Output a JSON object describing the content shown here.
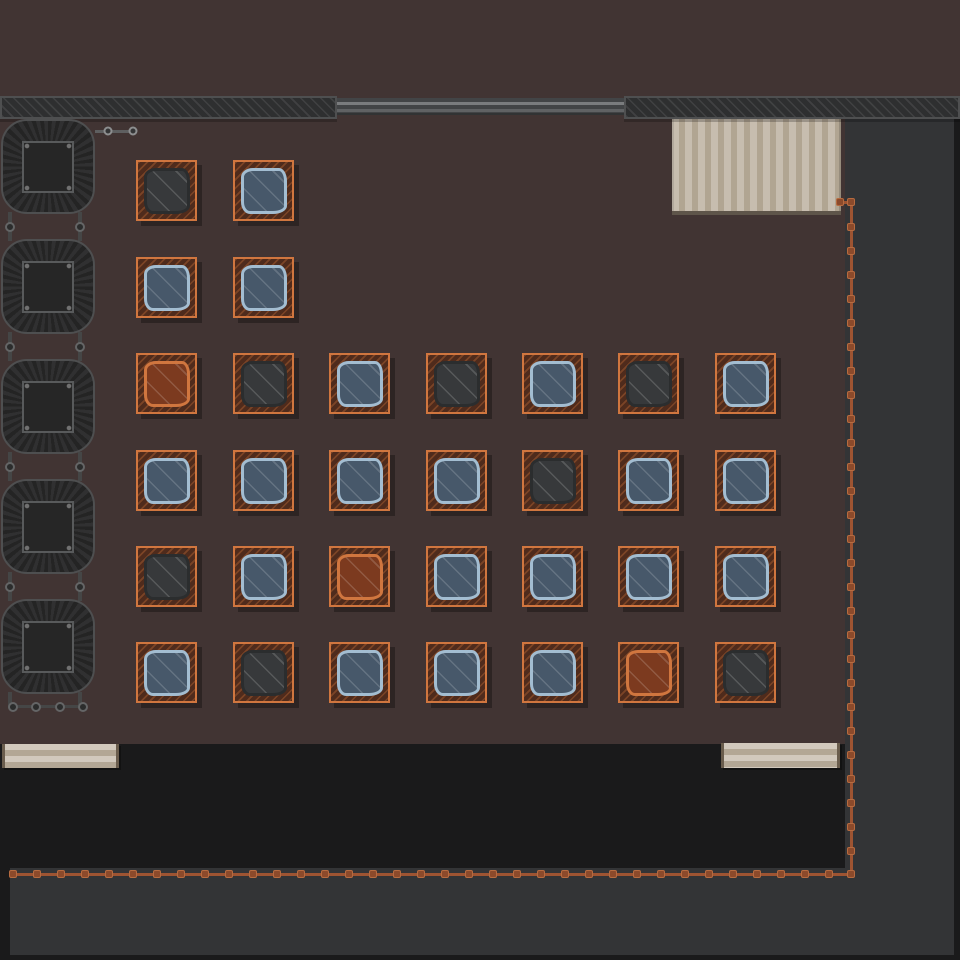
{
  "app": {
    "name": "factory-floor-topdown-view"
  },
  "palette": {
    "base_black": "#1a1a1b",
    "ground_brown": "#413433",
    "yard_gray": "#333436",
    "wall_fill": "#2e2f30",
    "wall_hatch": "#404142",
    "wall_border": "#4e4f50",
    "rail_band": "#424446",
    "rail_line_light": "#7a7c7e",
    "rail_line_mid": "#606264",
    "plank_light": "#c7bdaf",
    "plank_dark": "#b1a592",
    "plank_edge": "#5e554a",
    "table_light": "#d2c9bd",
    "table_dark": "#b3a795",
    "table_edge": "#6a5d4d",
    "pallet_border": "#d0763f",
    "pallet_fill": "#4f2b1c",
    "pallet_hatch": "rgba(224,124,62,0.30)",
    "machine_dark": "#242424",
    "machine_light": "#303031",
    "machine_border": "#4e4f50",
    "machine_center": "#262626",
    "machine_center_border": "#585a5b",
    "connector_bar": "#454646",
    "connector_node_ring": "#646566",
    "connector_node_fill": "#2b2c2c",
    "pipe_line": "#5e5f60",
    "pipe_node_ring": "#8d8e8f",
    "pipe_node_fill": "#343536",
    "wire_line": "#9e5432",
    "wire_node_fill": "#8c4a2b",
    "wire_node_border": "#b66b40",
    "cloth_blue_fill": "#47586a",
    "cloth_blue_rim": "#a3bdd1",
    "cloth_dark_fill": "#37393b",
    "cloth_dark_rim": "#2b2d2e",
    "cloth_orange_fill": "#7c3a1f",
    "cloth_orange_rim": "#d0763f"
  },
  "scene": {
    "regions": {
      "ground_top": {
        "x": 0,
        "y": 0,
        "w": 960,
        "h": 97
      },
      "room_floor": {
        "x": 0,
        "y": 96,
        "w": 845,
        "h": 648
      },
      "yard_right": {
        "x": 845,
        "y": 119,
        "w": 109,
        "h": 836
      },
      "yard_bottom": {
        "x": 10,
        "y": 868,
        "w": 944,
        "h": 87
      }
    },
    "walls": [
      {
        "id": "wall-top-left",
        "x": 0,
        "y": 96,
        "w": 337,
        "h": 23
      },
      {
        "id": "wall-top-right",
        "x": 624,
        "y": 96,
        "w": 336,
        "h": 23
      }
    ],
    "rail": {
      "x": 337,
      "y": 98,
      "w": 287,
      "h": 17
    },
    "plank_zone": {
      "x": 672,
      "y": 119,
      "w": 169,
      "h": 96
    },
    "tables": [
      {
        "id": "table-bottom-left",
        "x": 2,
        "y": 744,
        "w": 117,
        "h": 24
      },
      {
        "id": "table-bottom-right",
        "x": 721,
        "y": 743,
        "w": 119,
        "h": 25
      }
    ],
    "machines": {
      "x": 1,
      "width": 94,
      "height": 95,
      "tops": [
        119,
        239,
        359,
        479,
        599
      ],
      "connector_bar_offsets": [
        8,
        78
      ],
      "connector_bar_width": 4,
      "bottom_assembly": {
        "bars_y1": 692,
        "bars_y2": 708,
        "hbar": {
          "x": 9,
          "y": 705,
          "len": 76,
          "h": 3
        },
        "nodes_x": [
          13,
          36,
          60,
          83
        ],
        "nodes_y": 707
      },
      "top_pipe": {
        "bar": {
          "x": 95,
          "y": 130,
          "len": 39,
          "h": 3
        },
        "nodes": [
          [
            108,
            131
          ],
          [
            133,
            131
          ]
        ]
      }
    },
    "pallets": {
      "size": 61,
      "x_columns": [
        136,
        233,
        329,
        426,
        522,
        618,
        715
      ],
      "y_rows": [
        160,
        257,
        353,
        450,
        546,
        642
      ],
      "grid": [
        [
          "dark",
          "blue"
        ],
        [
          "blue",
          "blue"
        ],
        [
          "orange",
          "dark",
          "blue",
          "dark",
          "blue",
          "dark",
          "blue"
        ],
        [
          "blue",
          "blue",
          "blue",
          "blue",
          "dark",
          "blue",
          "blue"
        ],
        [
          "dark",
          "blue",
          "orange",
          "blue",
          "blue",
          "blue",
          "blue"
        ],
        [
          "blue",
          "dark",
          "blue",
          "blue",
          "blue",
          "orange",
          "dark"
        ]
      ]
    },
    "wire": {
      "thickness": 3,
      "segments": [
        {
          "id": "wire-top-stub",
          "dir": "h",
          "x": 839,
          "y": 201,
          "len": 13
        },
        {
          "id": "wire-right-run",
          "dir": "v",
          "x": 850,
          "y": 201,
          "len": 674
        },
        {
          "id": "wire-bottom-run",
          "dir": "h",
          "x": 9,
          "y": 873,
          "len": 843
        }
      ],
      "auto_nodes": [
        {
          "axis": "y",
          "fixed_x": 851,
          "from": 227,
          "to": 851,
          "step": 24
        },
        {
          "axis": "x",
          "fixed_y": 874,
          "from": 13,
          "to": 829,
          "step": 24
        }
      ],
      "extra_nodes": [
        [
          840,
          202
        ],
        [
          851,
          202
        ],
        [
          851,
          874
        ]
      ]
    }
  }
}
